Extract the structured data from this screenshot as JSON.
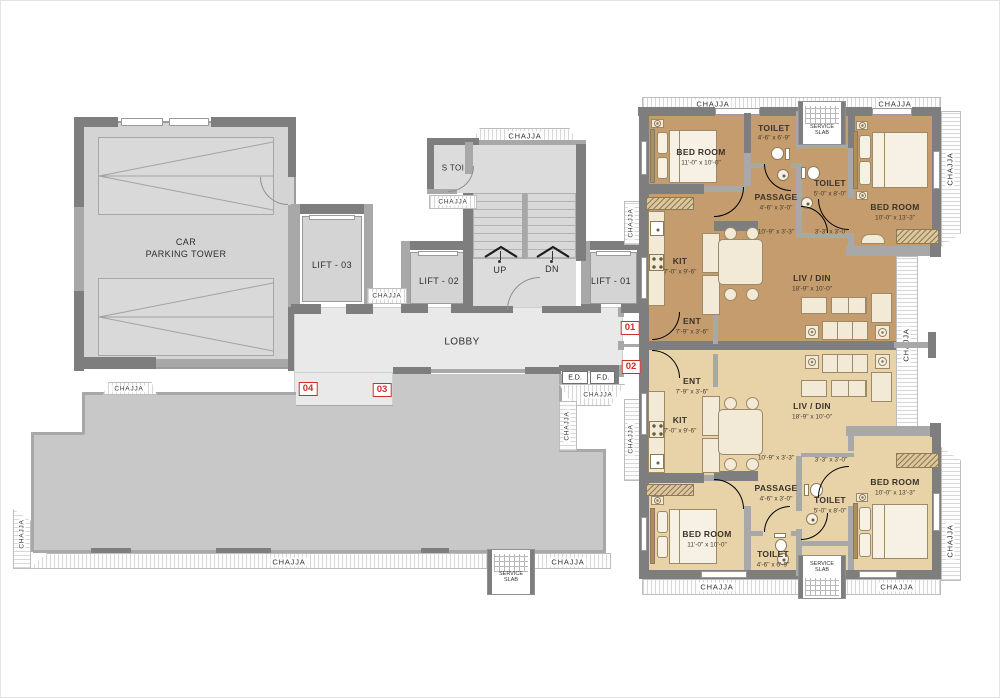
{
  "colors": {
    "unit_a_fill": "#c59c6d",
    "unit_b_fill": "#e8d2a8",
    "terrace_fill": "#c8c8c8",
    "lobby_fill": "#e9e9e9",
    "parking_fill": "#d4d4d4",
    "wall_dark": "#7e7e7e",
    "marker_red": "#cf2e24"
  },
  "labels": {
    "chajja": "CHAJJA",
    "service": "SERVICE",
    "slab": "SLAB",
    "lobby": "LOBBY",
    "car_line1": "CAR",
    "car_line2": "PARKING TOWER",
    "lift_01": "LIFT - 01",
    "lift_02": "LIFT - 02",
    "lift_03": "LIFT - 03",
    "s_toi": "S TOI",
    "up": "UP",
    "dn": "DN",
    "ed": "E.D.",
    "fd": "F.D."
  },
  "markers": {
    "m01": "01",
    "m02": "02",
    "m03": "03",
    "m04": "04"
  },
  "unit_a": {
    "bedroom_left": {
      "label": "BED ROOM",
      "dim": "11'-0\" x 10'-0\""
    },
    "toilet_top": {
      "label": "TOILET",
      "dim": "4'-6\" x 6'-9\""
    },
    "toilet_mid": {
      "label": "TOILET",
      "dim": "5'-0\" x 8'-0\""
    },
    "bedroom_right": {
      "label": "BED ROOM",
      "dim": "10'-0\" x 13'-3\""
    },
    "passage": {
      "label": "PASSAGE",
      "dim": "4'-6\" x 3'-0\""
    },
    "passage_dim_a": "10'-9\" x 3'-3\"",
    "passage_dim_b": "3'-3\" x 3'-0\"",
    "kitchen": {
      "label": "KIT",
      "dim": "7'-0\" x 9'-6\""
    },
    "living": {
      "label": "LIV / DIN",
      "dim": "18'-9\" x 10'-0\""
    },
    "entry": {
      "label": "ENT",
      "dim": "7'-9\" x 3'-6\""
    }
  },
  "unit_b": {
    "entry": {
      "label": "ENT",
      "dim": "7'-9\" x 3'-6\""
    },
    "kitchen": {
      "label": "KIT",
      "dim": "7'-0\" x 9'-6\""
    },
    "living": {
      "label": "LIV / DIN",
      "dim": "18'-9\" x 10'-0\""
    },
    "passage_dim_a": "10'-9\" x 3'-3\"",
    "passage_dim_b": "3'-3\" x 3'-0\"",
    "passage": {
      "label": "PASSAGE",
      "dim": "4'-6\" x 3'-0\""
    },
    "bedroom_right": {
      "label": "BED ROOM",
      "dim": "10'-0\" x 13'-3\""
    },
    "toilet_mid": {
      "label": "TOILET",
      "dim": "5'-0\" x 8'-0\""
    },
    "bedroom_left": {
      "label": "BED ROOM",
      "dim": "11'-0\" x 10'-0\""
    },
    "toilet_bottom": {
      "label": "TOILET",
      "dim": "4'-6\" x 6'-9\""
    }
  }
}
